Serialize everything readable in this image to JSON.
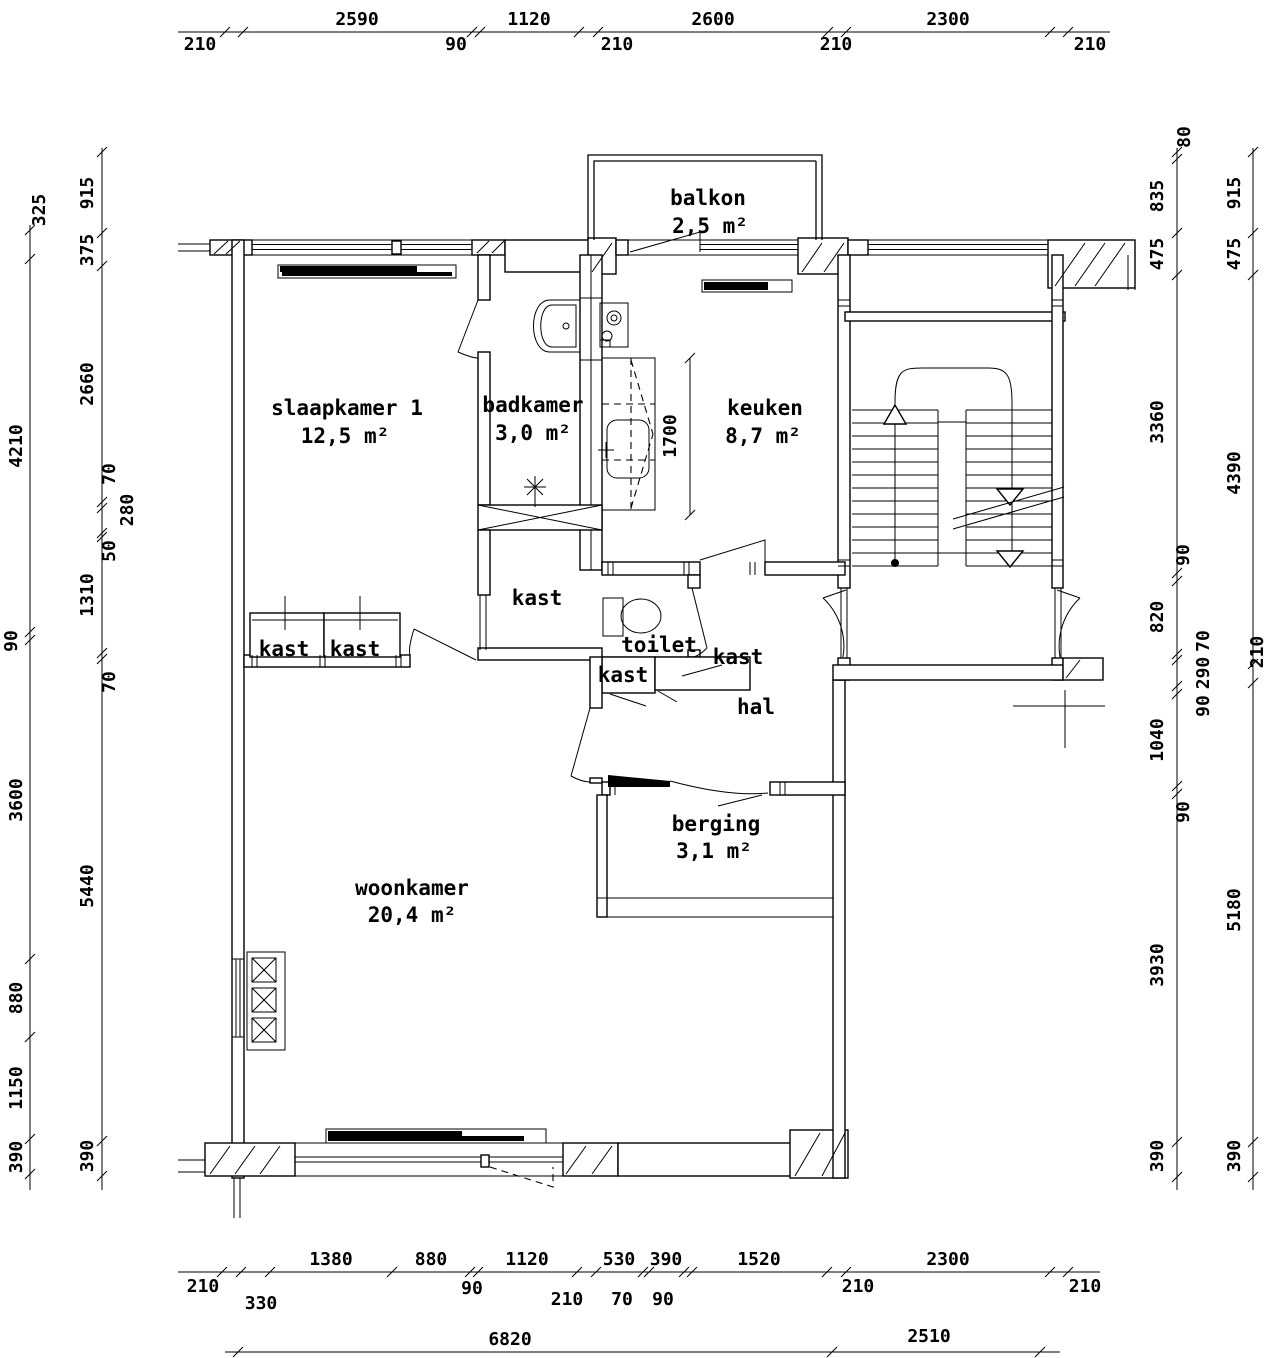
{
  "rooms": {
    "slaapkamer": {
      "name": "slaapkamer 1",
      "area": "12,5 m²"
    },
    "badkamer": {
      "name": "badkamer",
      "area": "3,0 m²"
    },
    "keuken": {
      "name": "keuken",
      "area": "8,7 m²"
    },
    "balkon": {
      "name": "balkon",
      "area": "2,5 m²"
    },
    "woonkamer": {
      "name": "woonkamer",
      "area": "20,4 m²"
    },
    "berging": {
      "name": "berging",
      "area": "3,1 m²"
    },
    "hal": {
      "name": "hal"
    },
    "toilet": {
      "name": "toilet"
    },
    "kast": {
      "name": "kast"
    }
  },
  "dims": {
    "top": [
      "210",
      "2590",
      "90",
      "1120",
      "210",
      "2600",
      "210",
      "2300",
      "210"
    ],
    "bottom_row1": [
      "210",
      "330",
      "1380",
      "880",
      "90",
      "1120",
      "210",
      "530",
      "70",
      "390",
      "90",
      "1520",
      "210",
      "2300",
      "210"
    ],
    "bottom_row2": [
      "6820",
      "2510"
    ],
    "left_outer": [
      "325",
      "4210",
      "90",
      "3600",
      "880",
      "1150",
      "390"
    ],
    "left_inner": [
      "915",
      "375",
      "2660",
      "70",
      "280",
      "50",
      "1310",
      "70",
      "5440",
      "390"
    ],
    "right_inner": [
      "80",
      "835",
      "475",
      "3360",
      "90",
      "820",
      "70",
      "290",
      "90",
      "1040",
      "90",
      "3930",
      "390"
    ],
    "right_outer": [
      "915",
      "475",
      "4390",
      "210",
      "5180",
      "390"
    ],
    "interior_kitchen": "1700"
  }
}
